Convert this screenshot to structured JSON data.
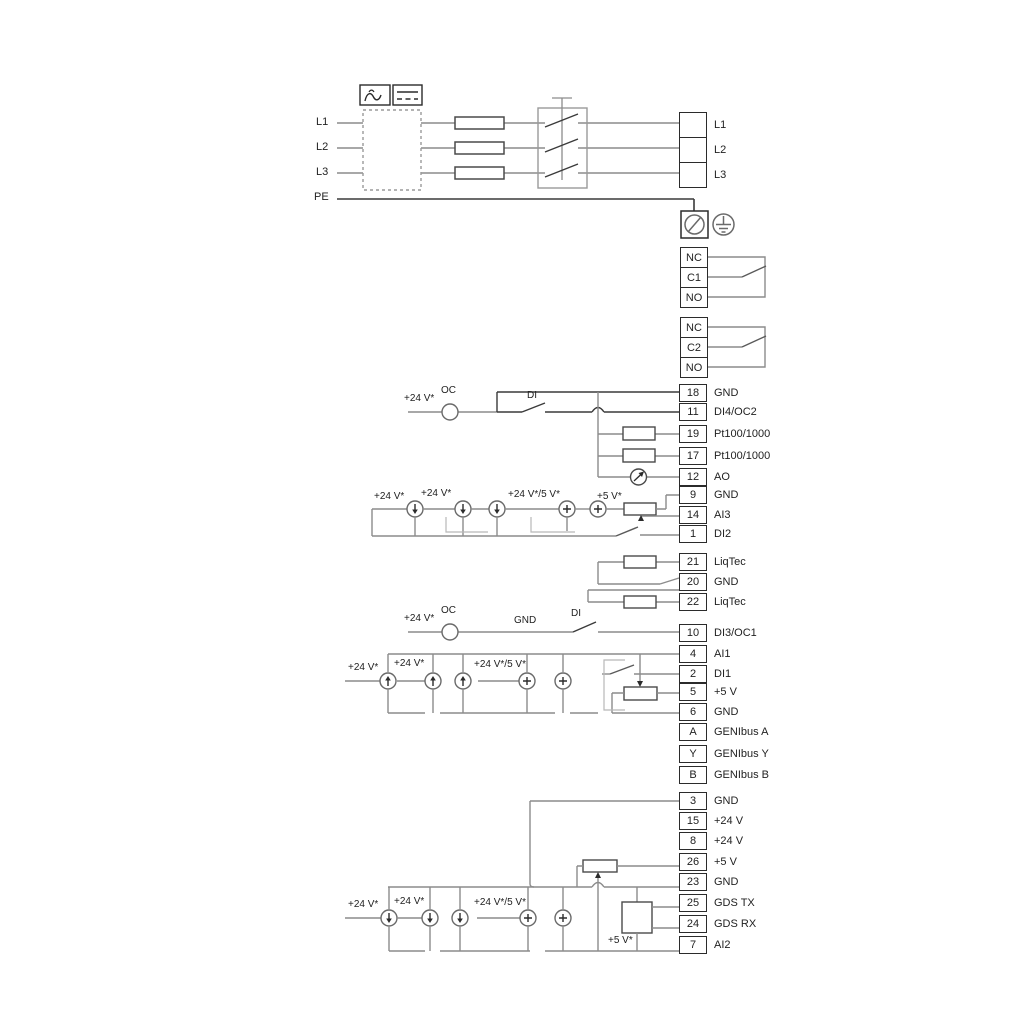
{
  "power_inputs": [
    "L1",
    "L2",
    "L3",
    "PE"
  ],
  "mains_out": [
    "L1",
    "L2",
    "L3"
  ],
  "relay1": [
    "NC",
    "C1",
    "NO"
  ],
  "relay2": [
    "NC",
    "C2",
    "NO"
  ],
  "terminals": [
    {
      "num": "18",
      "label": "GND"
    },
    {
      "num": "11",
      "label": "DI4/OC2"
    },
    {
      "num": "19",
      "label": "Pt100/1000"
    },
    {
      "num": "17",
      "label": "Pt100/1000"
    },
    {
      "num": "12",
      "label": "AO"
    },
    {
      "num": "9",
      "label": "GND"
    },
    {
      "num": "14",
      "label": "AI3"
    },
    {
      "num": "1",
      "label": "DI2"
    },
    {
      "num": "21",
      "label": "LiqTec"
    },
    {
      "num": "20",
      "label": "GND"
    },
    {
      "num": "22",
      "label": "LiqTec"
    },
    {
      "num": "10",
      "label": "DI3/OC1"
    },
    {
      "num": "4",
      "label": "AI1"
    },
    {
      "num": "2",
      "label": "DI1"
    },
    {
      "num": "5",
      "label": "+5 V"
    },
    {
      "num": "6",
      "label": "GND"
    },
    {
      "num": "A",
      "label": "GENIbus A"
    },
    {
      "num": "Y",
      "label": "GENIbus Y"
    },
    {
      "num": "B",
      "label": "GENIbus B"
    },
    {
      "num": "3",
      "label": "GND"
    },
    {
      "num": "15",
      "label": "+24 V"
    },
    {
      "num": "8",
      "label": "+24 V"
    },
    {
      "num": "26",
      "label": "+5 V"
    },
    {
      "num": "23",
      "label": "GND"
    },
    {
      "num": "25",
      "label": "GDS TX"
    },
    {
      "num": "24",
      "label": "GDS RX"
    },
    {
      "num": "7",
      "label": "AI2"
    }
  ],
  "annotations": {
    "g1_24v": "+24 V*",
    "g1_oc": "OC",
    "g1_di": "DI",
    "g2_24v_a": "+24 V*",
    "g2_24v_b": "+24 V*",
    "g2_24v5v": "+24 V*/5 V*",
    "g2_5v": "+5 V*",
    "g4_24v": "+24 V*",
    "g4_oc": "OC",
    "g4_gnd": "GND",
    "g4_di": "DI",
    "g5_24v_a": "+24 V*",
    "g5_24v_b": "+24 V*",
    "g5_24v5v": "+24 V*/5 V*",
    "g6_24v_a": "+24 V*",
    "g6_24v_b": "+24 V*",
    "g6_24v5v": "+24 V*/5 V*",
    "g6_5v": "+5 V*"
  },
  "icons": {
    "ac_symbol": "ac-wave-icon",
    "dc_symbol": "dc-line-icon",
    "pe_terminal": "pe-terminal-icon",
    "earth": "earth-ground-icon",
    "fuse": "fuse-icon",
    "contactor": "contactor-icon",
    "current_sink": "current-sink-icon",
    "current_source": "current-source-icon",
    "plus_source": "plus-source-icon",
    "resistor": "resistor-icon",
    "potentiometer": "potentiometer-icon",
    "analog_out_meter": "ao-meter-icon",
    "gds_sensor": "gds-sensor-box-icon",
    "open_collector": "open-collector-icon",
    "switch": "switch-contact-icon"
  },
  "colors": {
    "wire": "#8c8c8c",
    "dark": "#3a3a3a",
    "background": "#ffffff"
  }
}
